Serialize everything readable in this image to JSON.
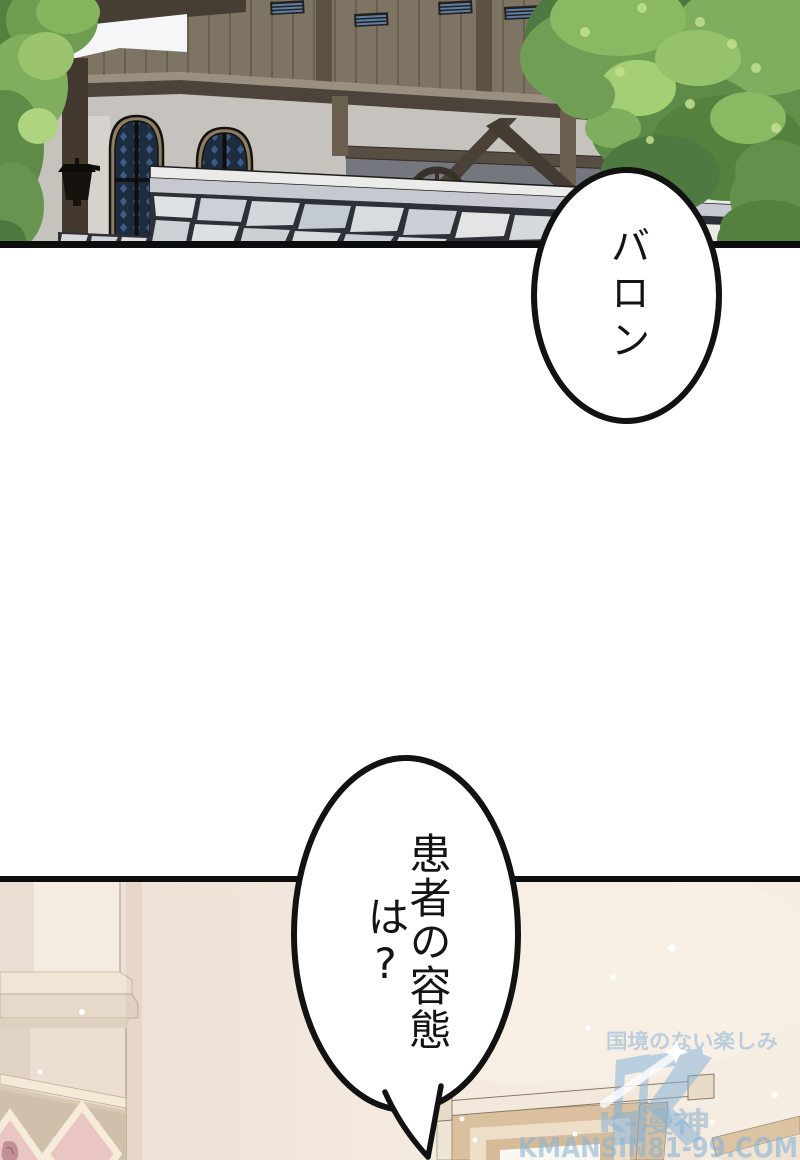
{
  "speech_bubbles": [
    {
      "text": "バロン"
    },
    {
      "text": "患者の容態は?"
    }
  ],
  "watermark": {
    "tagline": "国境のない楽しみ",
    "logo_letter": "K",
    "brand": "K-漫神",
    "site": "KMANSIN81-99.COM",
    "color": "#8ab4d6"
  },
  "colors": {
    "panel_border": "#0d0d0d",
    "bubble_outline": "#121212",
    "wall_cream": "#f4eadf",
    "stone_mortar": "#2d3036",
    "tree_green": "#63914c"
  }
}
